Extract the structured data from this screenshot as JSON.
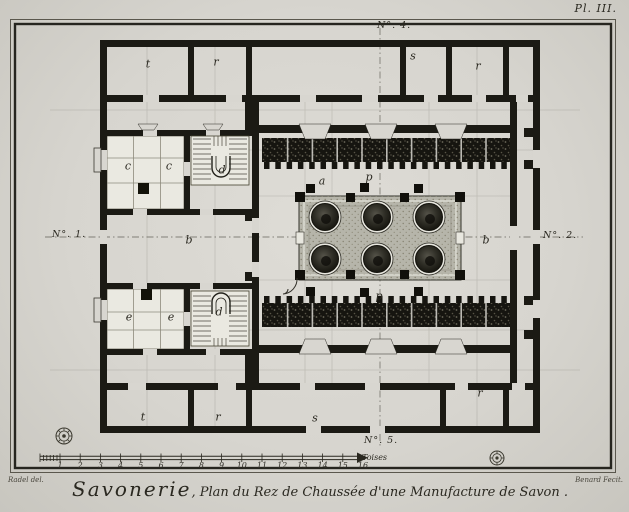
{
  "plate": {
    "number": "Pl. III.",
    "title_lead": "Savonerie",
    "title_rest": ", Plan du Rez de Chaussée d'une Manufacture de Savon .",
    "signature_left": "Radel del.",
    "signature_right": "Benard Fecit."
  },
  "axes": {
    "left": "N°. 1.",
    "right": "N°. 2.",
    "top": "N°. 4.",
    "bottom": "N°. 5."
  },
  "scale_bar": {
    "unit": "Toises",
    "numbers": [
      "1",
      "2",
      "3",
      "4",
      "5",
      "6",
      "7",
      "8",
      "9",
      "10",
      "11",
      "12",
      "13",
      "14",
      "15",
      "16"
    ]
  },
  "colors": {
    "paper": "#d8d6d0",
    "ink": "#1b1a14",
    "platform_gray": "#b6b5aa"
  },
  "room_labels": [
    {
      "text": "t",
      "x": 148,
      "y": 64
    },
    {
      "text": "r",
      "x": 216,
      "y": 62
    },
    {
      "text": "s",
      "x": 413,
      "y": 56
    },
    {
      "text": "r",
      "x": 478,
      "y": 66
    },
    {
      "text": "c",
      "x": 128,
      "y": 166
    },
    {
      "text": "c",
      "x": 169,
      "y": 166
    },
    {
      "text": "d",
      "x": 222,
      "y": 170
    },
    {
      "text": "a",
      "x": 322,
      "y": 181
    },
    {
      "text": "p",
      "x": 369,
      "y": 177
    },
    {
      "text": "b",
      "x": 189,
      "y": 240
    },
    {
      "text": "b",
      "x": 486,
      "y": 240
    },
    {
      "text": "e",
      "x": 129,
      "y": 317
    },
    {
      "text": "e",
      "x": 171,
      "y": 317
    },
    {
      "text": "d",
      "x": 219,
      "y": 312
    },
    {
      "text": "p",
      "x": 379,
      "y": 296
    },
    {
      "text": "t",
      "x": 143,
      "y": 417
    },
    {
      "text": "r",
      "x": 218,
      "y": 417
    },
    {
      "text": "s",
      "x": 315,
      "y": 418
    },
    {
      "text": "r",
      "x": 480,
      "y": 393
    }
  ]
}
